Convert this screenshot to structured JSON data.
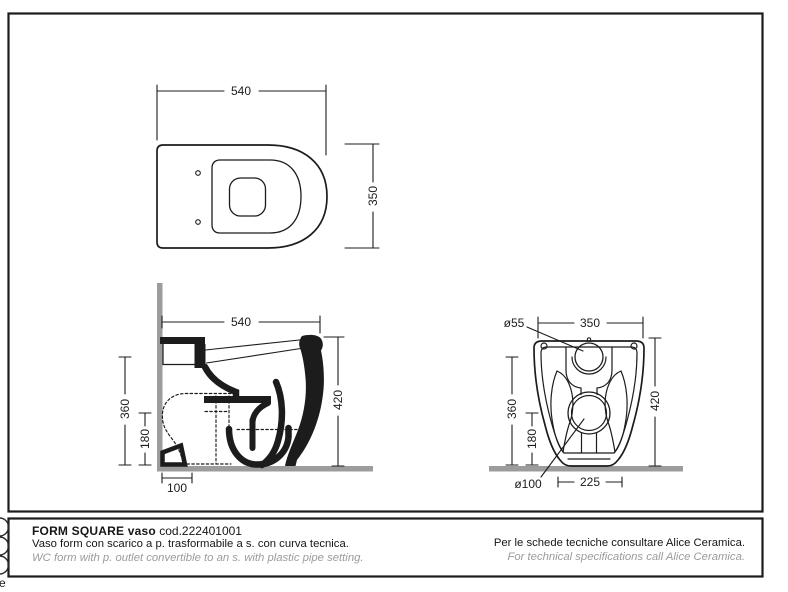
{
  "colors": {
    "line": "#1c1c1c",
    "surface": "#9c9c9c",
    "muted_text": "#9b9b9b"
  },
  "views": {
    "top": {
      "width": "540",
      "depth": "350"
    },
    "side": {
      "width": "540",
      "height": "420",
      "height_360": "360",
      "height_180": "180",
      "offset_100": "100"
    },
    "front": {
      "width": "350",
      "height": "420",
      "height_360": "360",
      "height_180": "180",
      "span_225": "225",
      "inlet_diameter": "ø55",
      "outlet_diameter": "ø100"
    }
  },
  "footer": {
    "product": "FORM SQUARE vaso",
    "code": "cod.222401001",
    "description_it": "Vaso form con scarico a p. trasformabile a s. con curva tecnica.",
    "description_en": "WC form with p. outlet convertible to an s. with plastic pipe setting.",
    "note_it": "Per le schede tecniche consultare Alice Ceramica.",
    "note_en": "For technical specifications call Alice Ceramica."
  },
  "edge": {
    "mark": "e"
  }
}
